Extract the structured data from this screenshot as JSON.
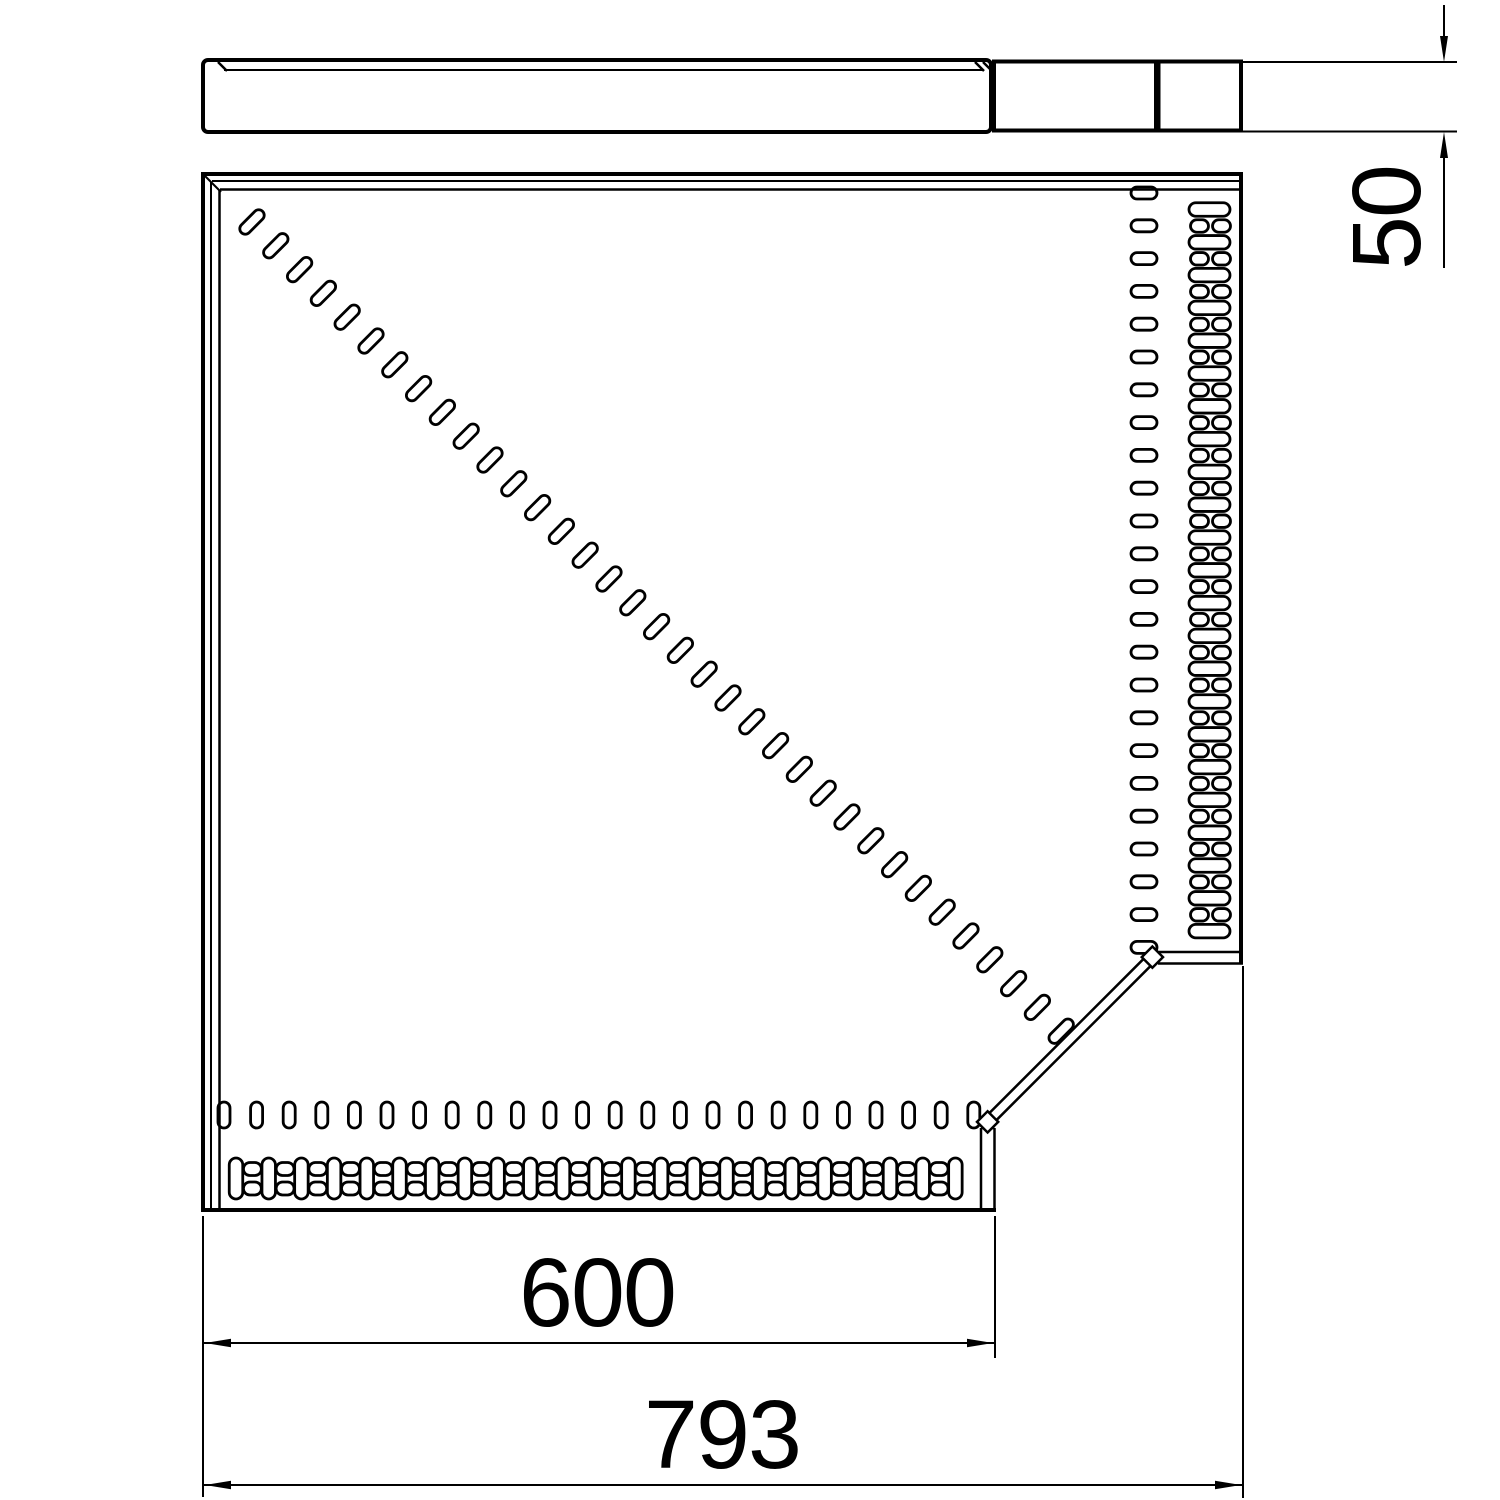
{
  "drawing": {
    "colors": {
      "line": "#000000",
      "background": "#ffffff"
    },
    "dimensions": {
      "profile_height": "50",
      "inner_width": "600",
      "overall_width": "793"
    }
  }
}
